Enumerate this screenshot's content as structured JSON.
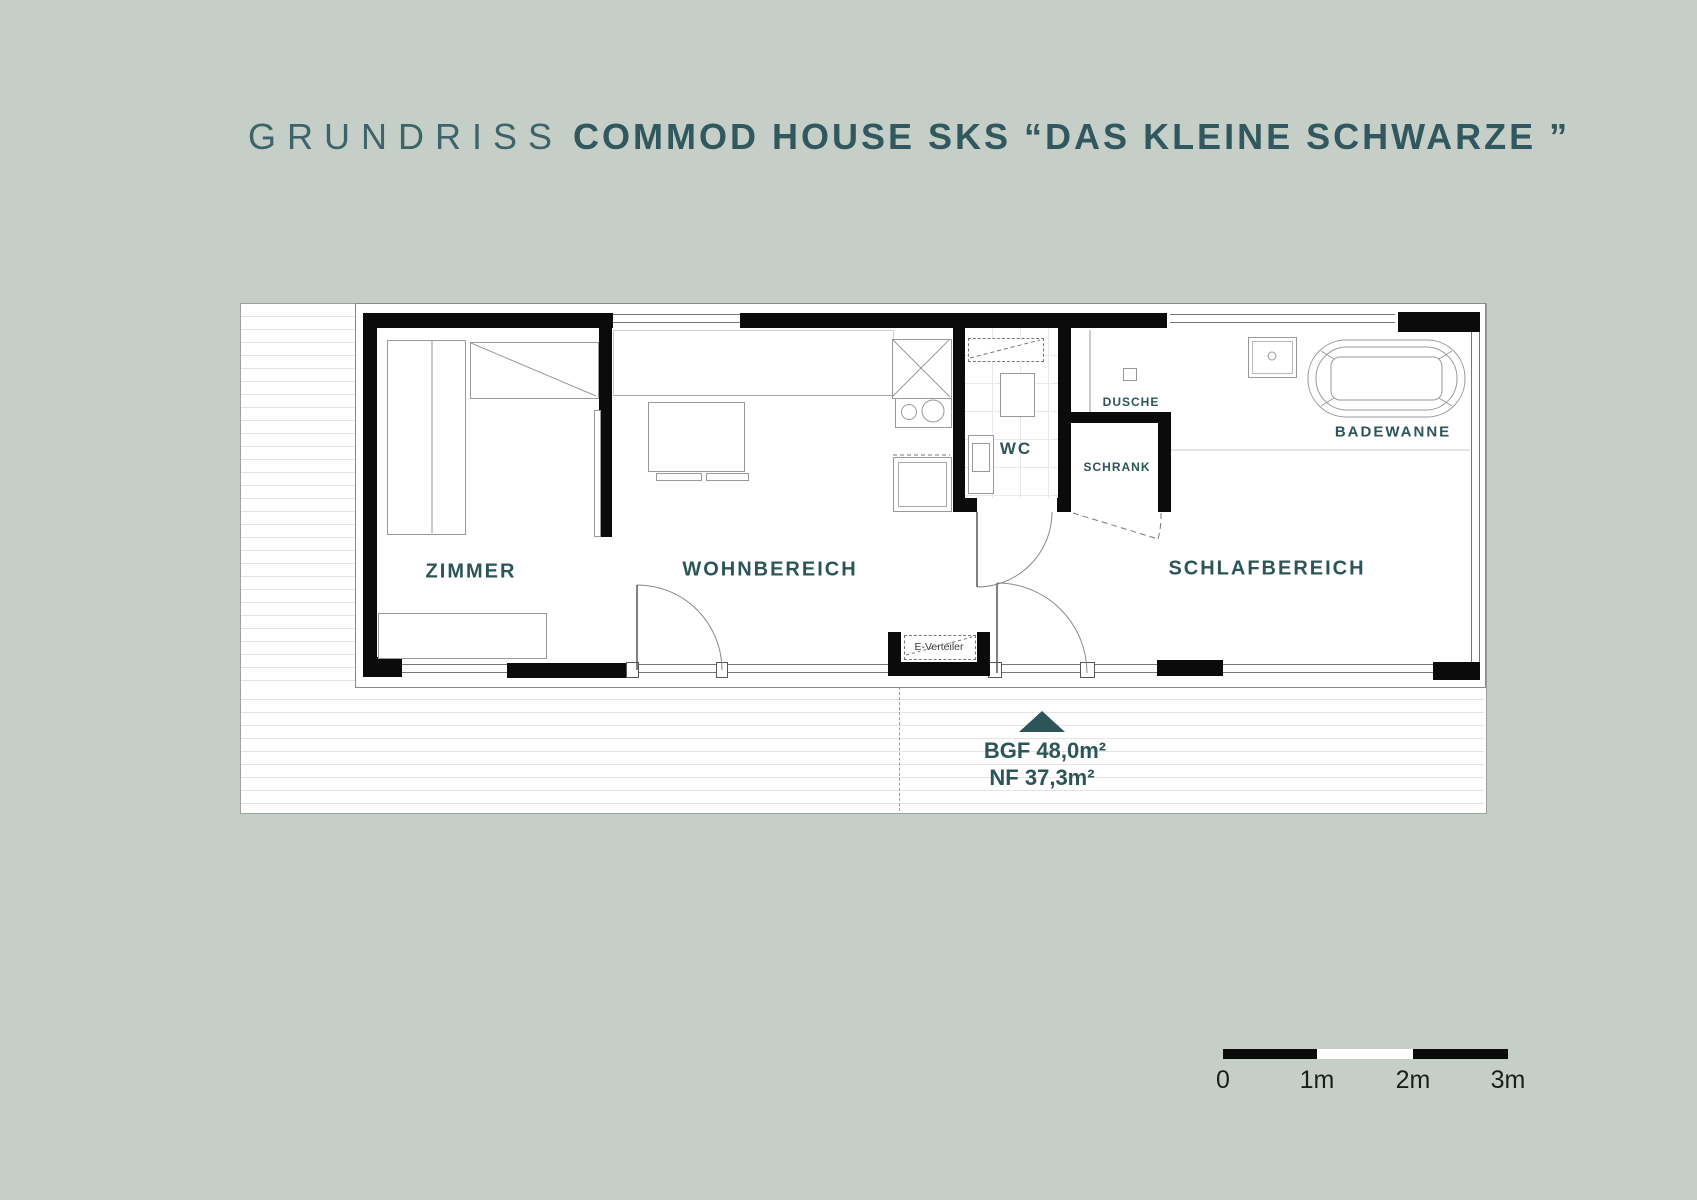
{
  "title": {
    "prefix": "GRUNDRISS",
    "main": "COMMOD HOUSE SKS “DAS KLEINE SCHWARZE ”"
  },
  "plan": {
    "rooms": [
      {
        "id": "zimmer",
        "label": "ZIMMER"
      },
      {
        "id": "wohnbereich",
        "label": "WOHNBEREICH"
      },
      {
        "id": "wc",
        "label": "WC"
      },
      {
        "id": "dusche",
        "label": "DUSCHE"
      },
      {
        "id": "schrank",
        "label": "SCHRANK"
      },
      {
        "id": "schlafbereich",
        "label": "SCHLAFBEREICH"
      }
    ],
    "fixtures": {
      "badewanne": "BADEWANNE",
      "e_verteiler": "E-Verteiler"
    },
    "annotation": {
      "bgf": "BGF 48,0m²",
      "nf": "NF 37,3m²"
    },
    "scale": {
      "labels": [
        "0",
        "1m",
        "2m",
        "3m"
      ]
    }
  },
  "colors": {
    "background": "#c6cfc7",
    "accent": "#2c555a",
    "title": "#30585e",
    "wall": "#0b0b0b"
  }
}
